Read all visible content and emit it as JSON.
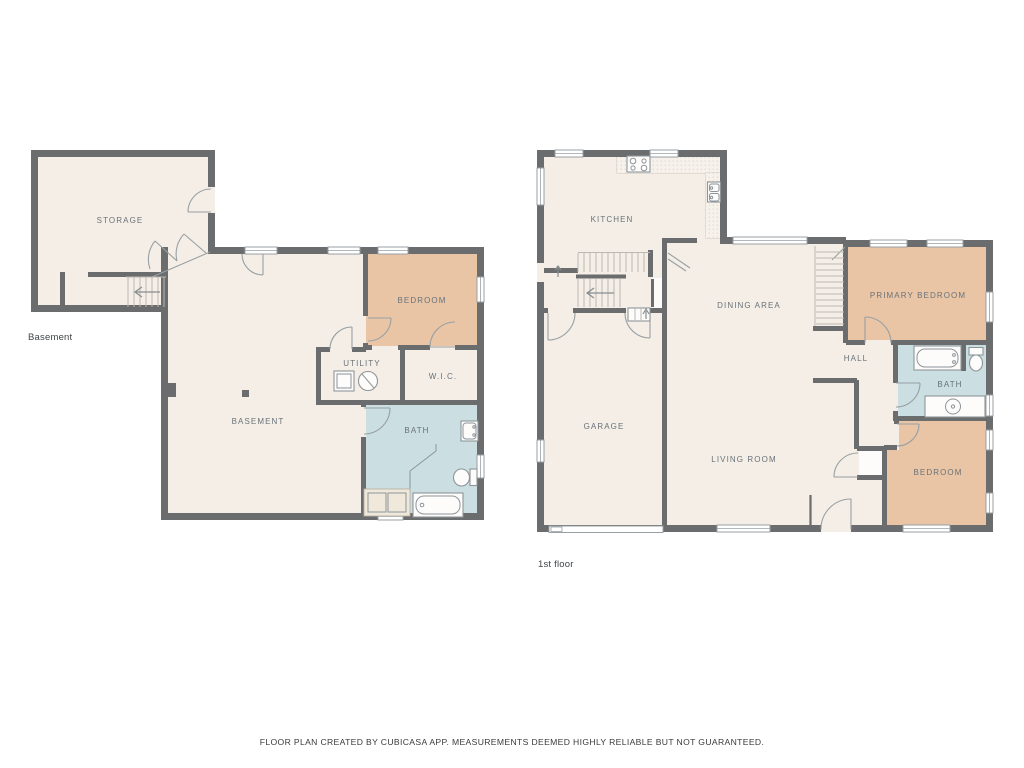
{
  "footer": {
    "text": "FLOOR PLAN CREATED BY CUBICASA APP. MEASUREMENTS DEEMED HIGHLY RELIABLE BUT NOT GUARANTEED."
  },
  "colors": {
    "wall": "#6a6c6d",
    "cream": "#f4eee6",
    "tan": "#e9c5a6",
    "blue": "#cbdee1",
    "line": "#98a0a4",
    "fixture": "#8d959a",
    "stair": "#bcb8b1",
    "label": "#68727a",
    "floorlabel": "#3f4447",
    "counter": "#f6f1ea",
    "white": "#fdfcfa",
    "vanity": "#f0e8db"
  },
  "basement": {
    "floor_label": "Basement",
    "rooms": {
      "storage": "STORAGE",
      "bedroom": "BEDROOM",
      "utility": "UTILITY",
      "wic": "W.I.C.",
      "bath": "BATH",
      "basement": "BASEMENT"
    }
  },
  "first_floor": {
    "floor_label": "1st floor",
    "rooms": {
      "kitchen": "KITCHEN",
      "dining_area": "DINING AREA",
      "primary_bedroom": "PRIMARY BEDROOM",
      "hall": "HALL",
      "bath": "BATH",
      "garage": "GARAGE",
      "living_room": "LIVING ROOM",
      "bedroom": "BEDROOM"
    }
  }
}
